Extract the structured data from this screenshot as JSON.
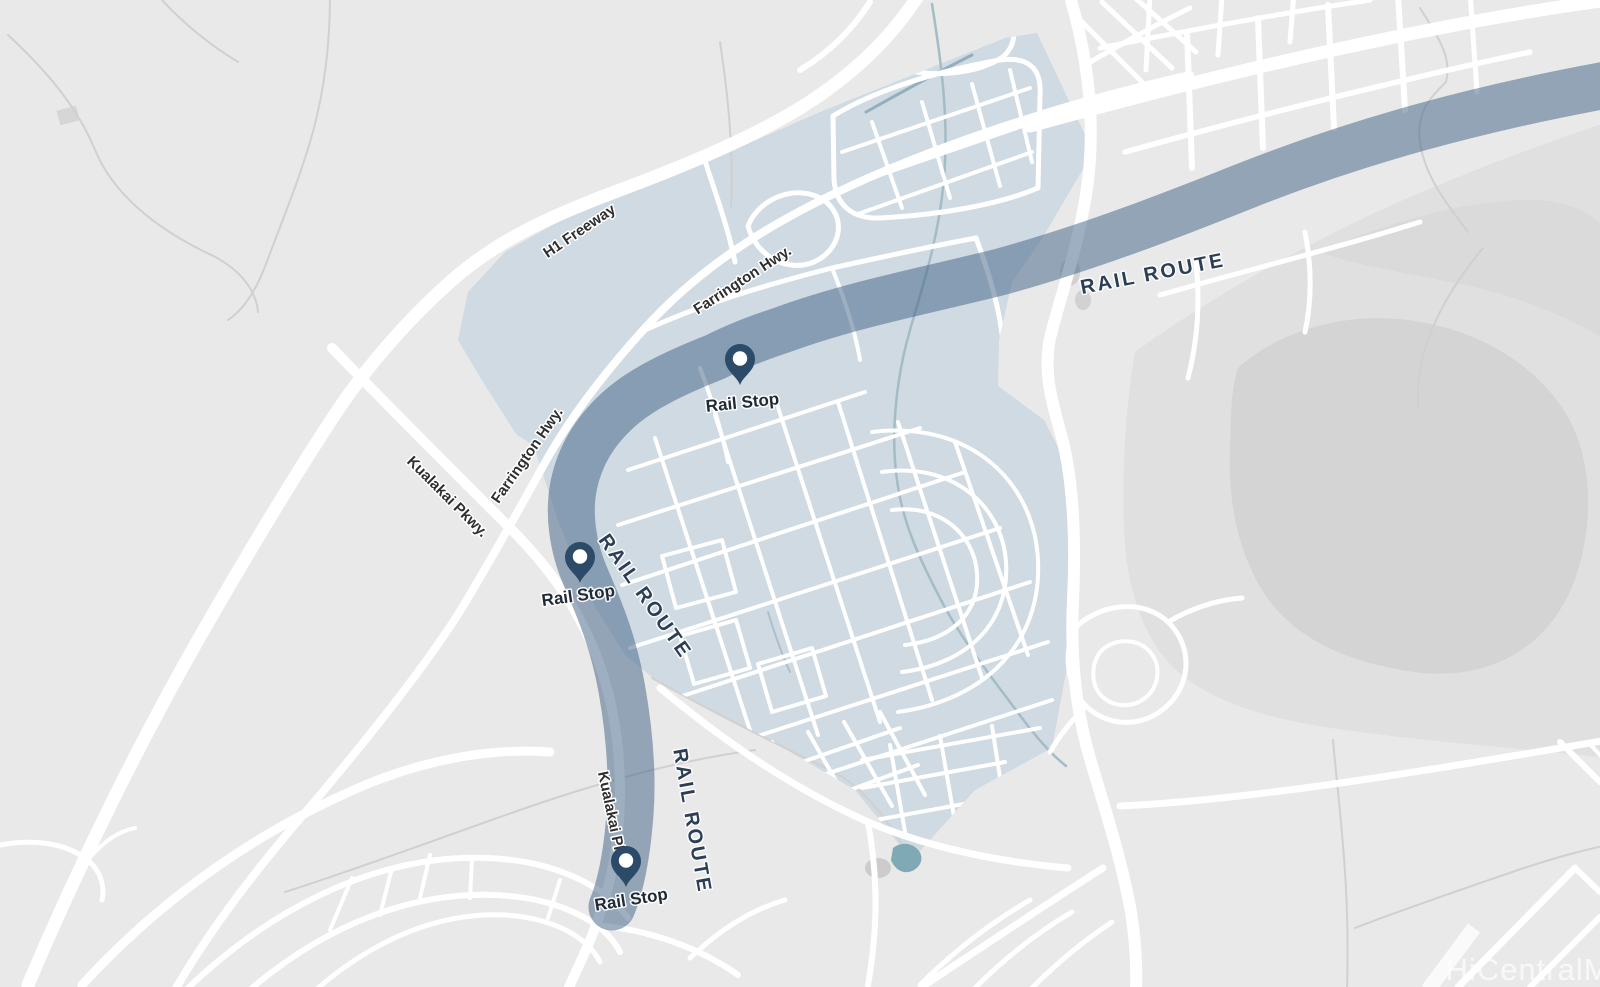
{
  "map": {
    "description": "Rail route overview map with highlighted development region",
    "road_labels": [
      {
        "text": "H1 Freeway"
      },
      {
        "text": "Farrington Hwy."
      },
      {
        "text": "Farrington Hwy."
      },
      {
        "text": "Kualakai Pkwy."
      },
      {
        "text": "Kualakai Pkwy."
      }
    ],
    "rail": {
      "route_labels": [
        {
          "text": "RAIL ROUTE"
        },
        {
          "text": "RAIL ROUTE"
        },
        {
          "text": "RAIL ROUTE"
        }
      ],
      "stops": [
        {
          "label": "Rail Stop"
        },
        {
          "label": "Rail Stop"
        },
        {
          "label": "Rail Stop"
        }
      ]
    },
    "watermark": {
      "text": "HiCentralMLS"
    },
    "colors": {
      "background": "#e9e9e9",
      "road": "#ffffff",
      "highlight_region": "#cfdae2",
      "rail_band": "rgba(61,95,131,0.5)",
      "pin": "#2c4b69",
      "label_dark": "#2b3e55",
      "terrain_gray": "#d4d4d4"
    }
  }
}
